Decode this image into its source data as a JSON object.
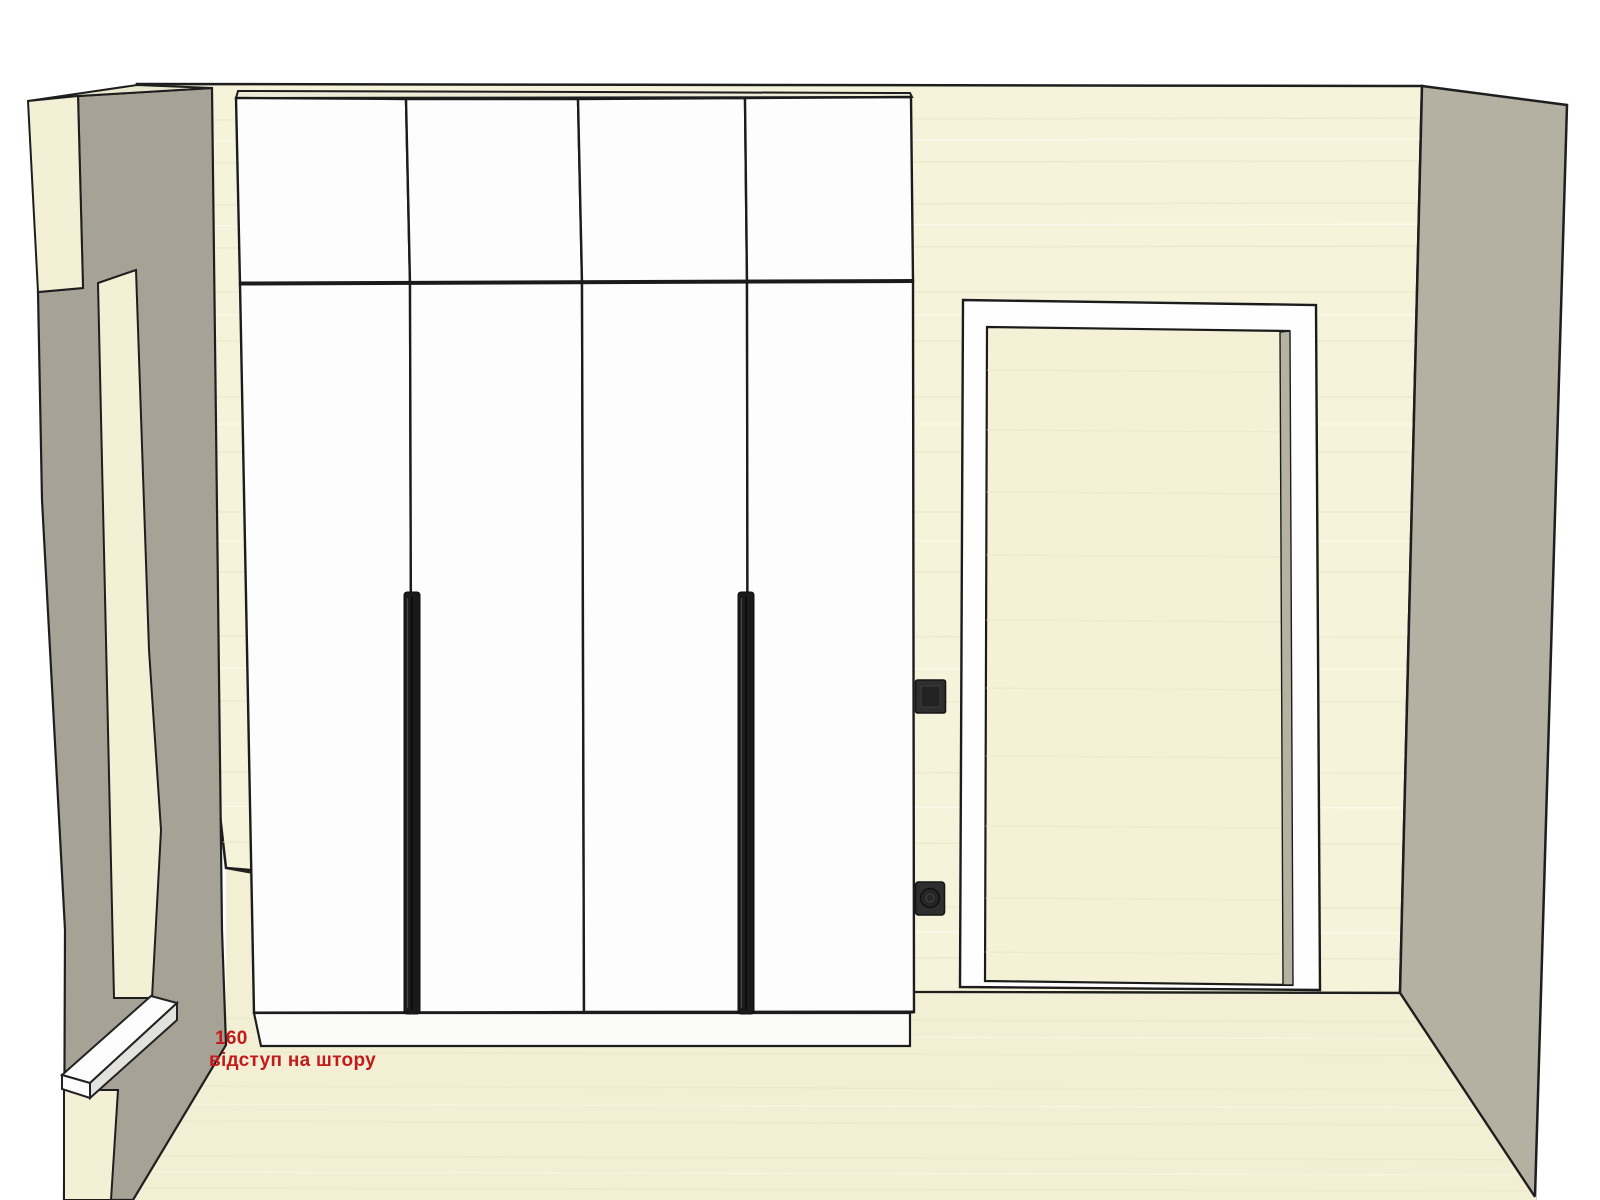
{
  "annotation": {
    "value": "160",
    "label": "відступ на штору"
  },
  "colors": {
    "background": "#ffffff",
    "back_wall": "#f6f3db",
    "floor": "#f3efd4",
    "left_wall_gray": "#a6a396",
    "right_wall_gray": "#b4b1a3",
    "cream_face": "#f3f0d6",
    "top_face": "#ebe8d0",
    "wardrobe_white": "#fdfdfd",
    "wardrobe_top_strip": "#edead6",
    "plinth_white": "#fbfbfa",
    "outline": "#1e1e1e",
    "handle_black": "#1a1a1a",
    "door_leaf": "#f4f1d7",
    "frame_white": "#fefefe",
    "hinge_gap": "#b5b2a2",
    "switch_dark": "#2e2e2e",
    "switch_inner": "#232323",
    "socket_circle": "#262626",
    "shelf_white": "#fcfcfc",
    "shelf_side": "#e2e2de",
    "annotation_red": "#c31b1b"
  },
  "scene": {
    "wardrobe": {
      "mezzanine_door_count": 4,
      "main_door_count": 4,
      "handle_count": 2
    },
    "electrical": {
      "switch": "light-switch",
      "socket": "power-socket"
    }
  }
}
